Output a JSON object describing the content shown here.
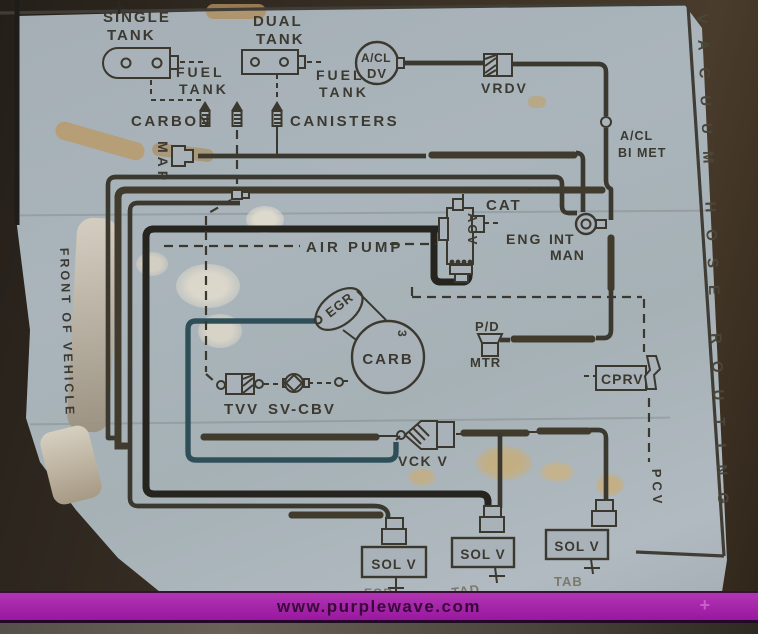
{
  "watermark": {
    "url_text": "www.purplewave.com",
    "plus_mark": "+"
  },
  "diagram": {
    "edge_titles": {
      "right": "VACUUM HOSE ROUTING",
      "left": "FRONT OF VEHICLE"
    },
    "labels": {
      "single": "SINGLE",
      "dual": "DUAL",
      "tank": "TANK",
      "fuel": "FUEL",
      "carbon": "CARBON",
      "canisters": "CANISTERS",
      "map": "MAP",
      "acl": "A/CL",
      "dv": "DV",
      "vrdv": "VRDV",
      "bi_met": "BI MET",
      "cat": "CAT",
      "acv": "ACV",
      "air_pump": "AIR PUMP",
      "eng": "ENG",
      "int": "INT",
      "man": "MAN",
      "egr": "EGR",
      "carb": "CARB",
      "carb_port": "3",
      "pd": "P/D",
      "mtr": "MTR",
      "tvv": "TVV",
      "sv_cbv": "SV-CBV",
      "cprv": "CPRV",
      "vck_v": "VCK V",
      "pcv": "PCV",
      "sol_v": "SOL V",
      "tad": "TAD",
      "tab": "TAB",
      "egr_sol": "EGR"
    },
    "colors": {
      "decal_background": "#a8b2b8",
      "line_black": "#3b382f",
      "hose_tan": "#a89672",
      "hose_teal": "#5d93a4",
      "banner_purple": "#a21ba6"
    }
  }
}
